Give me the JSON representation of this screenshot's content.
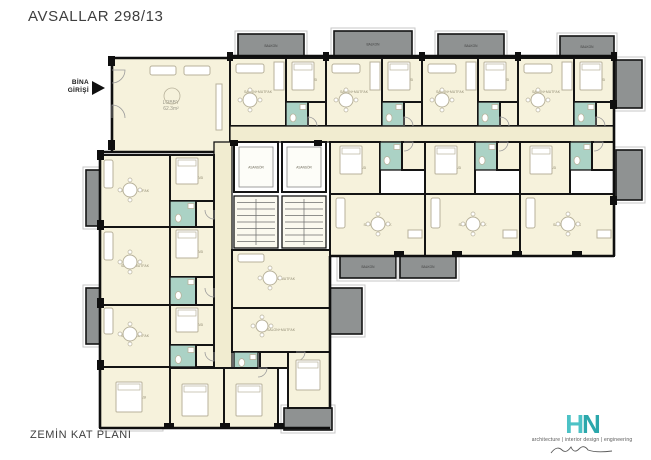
{
  "title": "AVSALLAR 298/13",
  "entrance": {
    "line1": "BİNA",
    "line2": "GİRİŞİ"
  },
  "footer": {
    "floor_label": "ZEMİN KAT PLANI"
  },
  "logo": {
    "h": "H",
    "n": "N",
    "tagline": "architecture | interior design | engineering"
  },
  "colors": {
    "room": "#f6f2dc",
    "corridor": "#f1ecd0",
    "bath": "#abd2c5",
    "stair": "#fbf9ef",
    "lift": "#ffffff",
    "balcony": "#8f9292",
    "balcony_frame": "#c7c7c7",
    "wall": "#141414",
    "furniture": "#b8b29b",
    "door": "#9b9b9b",
    "label": "#928c74",
    "balcony_label": "#3e3e3e",
    "logo_teal": "#3cb8bc"
  },
  "plan": {
    "rooms": [
      {
        "x": 112,
        "y": 58,
        "w": 118,
        "h": 94,
        "t": "room",
        "l": "LOBBY",
        "a": "62.3m²"
      },
      {
        "x": 230,
        "y": 58,
        "w": 56,
        "h": 68,
        "t": "room",
        "l": "SALON+MUTFAK"
      },
      {
        "x": 286,
        "y": 58,
        "w": 40,
        "h": 44,
        "t": "room",
        "l": "YATAK ODASI"
      },
      {
        "x": 286,
        "y": 102,
        "w": 22,
        "h": 24,
        "t": "bath"
      },
      {
        "x": 308,
        "y": 102,
        "w": 18,
        "h": 24,
        "t": "room"
      },
      {
        "x": 326,
        "y": 58,
        "w": 56,
        "h": 68,
        "t": "room",
        "l": "SALON+MUTFAK"
      },
      {
        "x": 382,
        "y": 58,
        "w": 40,
        "h": 44,
        "t": "room",
        "l": "YATAK ODASI"
      },
      {
        "x": 382,
        "y": 102,
        "w": 22,
        "h": 24,
        "t": "bath"
      },
      {
        "x": 404,
        "y": 102,
        "w": 18,
        "h": 24,
        "t": "room"
      },
      {
        "x": 422,
        "y": 58,
        "w": 56,
        "h": 68,
        "t": "room",
        "l": "SALON+MUTFAK"
      },
      {
        "x": 478,
        "y": 58,
        "w": 40,
        "h": 44,
        "t": "room",
        "l": "YATAK ODASI"
      },
      {
        "x": 478,
        "y": 102,
        "w": 22,
        "h": 24,
        "t": "bath"
      },
      {
        "x": 500,
        "y": 102,
        "w": 18,
        "h": 24,
        "t": "room"
      },
      {
        "x": 518,
        "y": 58,
        "w": 56,
        "h": 68,
        "t": "room",
        "l": "SALON+MUTFAK"
      },
      {
        "x": 574,
        "y": 58,
        "w": 40,
        "h": 44,
        "t": "room",
        "l": "YATAK ODASI"
      },
      {
        "x": 574,
        "y": 102,
        "w": 22,
        "h": 24,
        "t": "bath"
      },
      {
        "x": 596,
        "y": 102,
        "w": 18,
        "h": 24,
        "t": "room"
      },
      {
        "x": 230,
        "y": 126,
        "w": 384,
        "h": 16,
        "t": "corridor"
      },
      {
        "x": 330,
        "y": 142,
        "w": 50,
        "h": 52,
        "t": "room",
        "l": "YATAK ODASI"
      },
      {
        "x": 380,
        "y": 142,
        "w": 22,
        "h": 28,
        "t": "bath"
      },
      {
        "x": 402,
        "y": 142,
        "w": 23,
        "h": 28,
        "t": "room"
      },
      {
        "x": 330,
        "y": 194,
        "w": 95,
        "h": 62,
        "t": "room",
        "l": "SALON+MUTFAK"
      },
      {
        "x": 425,
        "y": 142,
        "w": 50,
        "h": 52,
        "t": "room",
        "l": "YATAK ODASI"
      },
      {
        "x": 475,
        "y": 142,
        "w": 22,
        "h": 28,
        "t": "bath"
      },
      {
        "x": 497,
        "y": 142,
        "w": 23,
        "h": 28,
        "t": "room"
      },
      {
        "x": 425,
        "y": 194,
        "w": 95,
        "h": 62,
        "t": "room",
        "l": "SALON+MUTFAK"
      },
      {
        "x": 520,
        "y": 142,
        "w": 50,
        "h": 52,
        "t": "room",
        "l": "YATAK ODASI"
      },
      {
        "x": 570,
        "y": 142,
        "w": 22,
        "h": 28,
        "t": "bath"
      },
      {
        "x": 592,
        "y": 142,
        "w": 22,
        "h": 28,
        "t": "room"
      },
      {
        "x": 520,
        "y": 194,
        "w": 94,
        "h": 62,
        "t": "room",
        "l": "SALON+MUTFAK"
      },
      {
        "x": 234,
        "y": 142,
        "w": 44,
        "h": 50,
        "t": "lift",
        "l": "ASANSÖR"
      },
      {
        "x": 282,
        "y": 142,
        "w": 44,
        "h": 50,
        "t": "lift",
        "l": "ASANSÖR"
      },
      {
        "x": 234,
        "y": 196,
        "w": 44,
        "h": 52,
        "t": "stair"
      },
      {
        "x": 282,
        "y": 196,
        "w": 44,
        "h": 52,
        "t": "stair"
      },
      {
        "x": 214,
        "y": 142,
        "w": 18,
        "h": 238,
        "t": "corridor"
      },
      {
        "x": 100,
        "y": 155,
        "w": 70,
        "h": 72,
        "t": "room",
        "l": "SALON+MUTFAK"
      },
      {
        "x": 170,
        "y": 155,
        "w": 44,
        "h": 46,
        "t": "room",
        "l": "YATAK ODASI"
      },
      {
        "x": 170,
        "y": 201,
        "w": 26,
        "h": 26,
        "t": "bath"
      },
      {
        "x": 196,
        "y": 201,
        "w": 18,
        "h": 26,
        "t": "room"
      },
      {
        "x": 100,
        "y": 227,
        "w": 70,
        "h": 78,
        "t": "room",
        "l": "SALON+MUTFAK"
      },
      {
        "x": 170,
        "y": 227,
        "w": 44,
        "h": 50,
        "t": "room",
        "l": "YATAK ODASI"
      },
      {
        "x": 170,
        "y": 277,
        "w": 26,
        "h": 28,
        "t": "bath"
      },
      {
        "x": 196,
        "y": 277,
        "w": 18,
        "h": 28,
        "t": "room"
      },
      {
        "x": 100,
        "y": 305,
        "w": 70,
        "h": 62,
        "t": "room",
        "l": "SALON+MUTFAK"
      },
      {
        "x": 170,
        "y": 305,
        "w": 44,
        "h": 40,
        "t": "room",
        "l": "YATAK ODASI"
      },
      {
        "x": 170,
        "y": 345,
        "w": 26,
        "h": 22,
        "t": "bath"
      },
      {
        "x": 196,
        "y": 345,
        "w": 18,
        "h": 22,
        "t": "room"
      },
      {
        "x": 100,
        "y": 367,
        "w": 70,
        "h": 61,
        "t": "room",
        "l": "YATAK ODASI"
      },
      {
        "x": 232,
        "y": 250,
        "w": 98,
        "h": 58,
        "t": "room",
        "l": "SALON+MUTFAK"
      },
      {
        "x": 232,
        "y": 308,
        "w": 98,
        "h": 44,
        "t": "room",
        "l": "SALON+MUTFAK"
      },
      {
        "x": 234,
        "y": 352,
        "w": 24,
        "h": 16,
        "t": "bath"
      },
      {
        "x": 260,
        "y": 352,
        "w": 28,
        "h": 16,
        "t": "room"
      },
      {
        "x": 170,
        "y": 368,
        "w": 54,
        "h": 60,
        "t": "room",
        "l": "YATAK ODASI"
      },
      {
        "x": 224,
        "y": 368,
        "w": 54,
        "h": 60,
        "t": "room",
        "l": "YATAK ODASI"
      },
      {
        "x": 288,
        "y": 352,
        "w": 42,
        "h": 56,
        "t": "room",
        "l": "YATAK ODASI"
      }
    ],
    "balconies": [
      {
        "x": 238,
        "y": 34,
        "w": 66,
        "h": 24,
        "l": "BALKON"
      },
      {
        "x": 334,
        "y": 31,
        "w": 78,
        "h": 27,
        "l": "BALKON"
      },
      {
        "x": 438,
        "y": 34,
        "w": 66,
        "h": 24,
        "l": "BALKON"
      },
      {
        "x": 560,
        "y": 36,
        "w": 54,
        "h": 22,
        "l": "BALKON"
      },
      {
        "x": 616,
        "y": 60,
        "w": 26,
        "h": 48
      },
      {
        "x": 616,
        "y": 150,
        "w": 26,
        "h": 50
      },
      {
        "x": 340,
        "y": 256,
        "w": 56,
        "h": 22,
        "l": "BALKON"
      },
      {
        "x": 400,
        "y": 256,
        "w": 56,
        "h": 22,
        "l": "BALKON"
      },
      {
        "x": 86,
        "y": 170,
        "w": 16,
        "h": 56
      },
      {
        "x": 86,
        "y": 288,
        "w": 16,
        "h": 56
      },
      {
        "x": 330,
        "y": 288,
        "w": 32,
        "h": 46
      },
      {
        "x": 284,
        "y": 408,
        "w": 48,
        "h": 22
      },
      {
        "x": 104,
        "y": 400,
        "w": 56,
        "h": 28
      }
    ],
    "walls": [
      [
        112,
        58,
        230,
        58
      ],
      [
        230,
        56,
        614,
        56
      ],
      [
        112,
        58,
        112,
        152
      ],
      [
        100,
        152,
        214,
        152
      ],
      [
        100,
        152,
        100,
        428
      ],
      [
        100,
        428,
        330,
        428
      ],
      [
        330,
        256,
        330,
        408
      ],
      [
        614,
        56,
        614,
        256
      ],
      [
        330,
        256,
        614,
        256
      ]
    ],
    "piers": [
      [
        227,
        52,
        6,
        9
      ],
      [
        323,
        52,
        6,
        9
      ],
      [
        419,
        52,
        6,
        9
      ],
      [
        515,
        52,
        6,
        9
      ],
      [
        611,
        52,
        6,
        9
      ],
      [
        97,
        150,
        7,
        10
      ],
      [
        97,
        220,
        7,
        10
      ],
      [
        97,
        298,
        7,
        10
      ],
      [
        97,
        360,
        7,
        10
      ],
      [
        108,
        56,
        7,
        10
      ],
      [
        108,
        140,
        7,
        10
      ],
      [
        164,
        423,
        10,
        6
      ],
      [
        220,
        423,
        10,
        6
      ],
      [
        274,
        423,
        10,
        6
      ],
      [
        610,
        100,
        7,
        9
      ],
      [
        610,
        196,
        7,
        9
      ],
      [
        394,
        251,
        10,
        6
      ],
      [
        452,
        251,
        10,
        6
      ],
      [
        512,
        251,
        10,
        6
      ],
      [
        572,
        251,
        10,
        6
      ],
      [
        230,
        140,
        8,
        6
      ],
      [
        314,
        140,
        8,
        6
      ]
    ],
    "doors": [
      {
        "x": 112,
        "y": 70,
        "r": 13,
        "q": 0
      },
      {
        "x": 112,
        "y": 118,
        "r": 13,
        "q": 3
      },
      {
        "x": 308,
        "y": 126,
        "r": 9,
        "q": 3
      },
      {
        "x": 404,
        "y": 126,
        "r": 9,
        "q": 3
      },
      {
        "x": 500,
        "y": 126,
        "r": 9,
        "q": 3
      },
      {
        "x": 596,
        "y": 126,
        "r": 9,
        "q": 3
      },
      {
        "x": 404,
        "y": 142,
        "r": 9,
        "q": 0
      },
      {
        "x": 499,
        "y": 142,
        "r": 9,
        "q": 0
      },
      {
        "x": 594,
        "y": 142,
        "r": 9,
        "q": 0
      },
      {
        "x": 214,
        "y": 210,
        "r": 9,
        "q": 1
      },
      {
        "x": 214,
        "y": 288,
        "r": 9,
        "q": 1
      },
      {
        "x": 214,
        "y": 352,
        "r": 9,
        "q": 1
      },
      {
        "x": 258,
        "y": 368,
        "r": 9,
        "q": 0
      },
      {
        "x": 296,
        "y": 352,
        "r": 9,
        "q": 0
      }
    ],
    "furniture": [
      {
        "t": "sofa",
        "x": 150,
        "y": 66,
        "w": 26,
        "h": 9
      },
      {
        "t": "sofa",
        "x": 184,
        "y": 66,
        "w": 26,
        "h": 9
      },
      {
        "t": "desk",
        "x": 216,
        "y": 84,
        "w": 6,
        "h": 46
      },
      {
        "t": "rug",
        "cx": 172,
        "cy": 96,
        "r": 8
      },
      {
        "t": "sofa",
        "x": 236,
        "y": 64,
        "w": 28,
        "h": 9
      },
      {
        "t": "table",
        "cx": 250,
        "cy": 100,
        "r": 7
      },
      {
        "t": "counter",
        "x": 274,
        "y": 62,
        "w": 10,
        "h": 28
      },
      {
        "t": "bed",
        "x": 292,
        "y": 62,
        "w": 22,
        "h": 28
      },
      {
        "t": "sofa",
        "x": 332,
        "y": 64,
        "w": 28,
        "h": 9
      },
      {
        "t": "table",
        "cx": 346,
        "cy": 100,
        "r": 7
      },
      {
        "t": "counter",
        "x": 370,
        "y": 62,
        "w": 10,
        "h": 28
      },
      {
        "t": "bed",
        "x": 388,
        "y": 62,
        "w": 22,
        "h": 28
      },
      {
        "t": "sofa",
        "x": 428,
        "y": 64,
        "w": 28,
        "h": 9
      },
      {
        "t": "table",
        "cx": 442,
        "cy": 100,
        "r": 7
      },
      {
        "t": "counter",
        "x": 466,
        "y": 62,
        "w": 10,
        "h": 28
      },
      {
        "t": "bed",
        "x": 484,
        "y": 62,
        "w": 22,
        "h": 28
      },
      {
        "t": "sofa",
        "x": 524,
        "y": 64,
        "w": 28,
        "h": 9
      },
      {
        "t": "table",
        "cx": 538,
        "cy": 100,
        "r": 7
      },
      {
        "t": "counter",
        "x": 562,
        "y": 62,
        "w": 10,
        "h": 28
      },
      {
        "t": "bed",
        "x": 580,
        "y": 62,
        "w": 22,
        "h": 28
      },
      {
        "t": "bed",
        "x": 340,
        "y": 146,
        "w": 22,
        "h": 28
      },
      {
        "t": "table",
        "cx": 378,
        "cy": 224,
        "r": 7
      },
      {
        "t": "sofa",
        "x": 336,
        "y": 198,
        "w": 9,
        "h": 30
      },
      {
        "t": "counter",
        "x": 408,
        "y": 230,
        "w": 14,
        "h": 8
      },
      {
        "t": "bed",
        "x": 435,
        "y": 146,
        "w": 22,
        "h": 28
      },
      {
        "t": "table",
        "cx": 473,
        "cy": 224,
        "r": 7
      },
      {
        "t": "sofa",
        "x": 431,
        "y": 198,
        "w": 9,
        "h": 30
      },
      {
        "t": "counter",
        "x": 503,
        "y": 230,
        "w": 14,
        "h": 8
      },
      {
        "t": "bed",
        "x": 530,
        "y": 146,
        "w": 22,
        "h": 28
      },
      {
        "t": "table",
        "cx": 568,
        "cy": 224,
        "r": 7
      },
      {
        "t": "sofa",
        "x": 526,
        "y": 198,
        "w": 9,
        "h": 30
      },
      {
        "t": "counter",
        "x": 597,
        "y": 230,
        "w": 14,
        "h": 8
      },
      {
        "t": "table",
        "cx": 130,
        "cy": 190,
        "r": 7
      },
      {
        "t": "sofa",
        "x": 104,
        "y": 160,
        "w": 9,
        "h": 28
      },
      {
        "t": "bed",
        "x": 176,
        "y": 158,
        "w": 22,
        "h": 26
      },
      {
        "t": "table",
        "cx": 130,
        "cy": 262,
        "r": 7
      },
      {
        "t": "sofa",
        "x": 104,
        "y": 232,
        "w": 9,
        "h": 28
      },
      {
        "t": "bed",
        "x": 176,
        "y": 230,
        "w": 22,
        "h": 28
      },
      {
        "t": "table",
        "cx": 130,
        "cy": 334,
        "r": 7
      },
      {
        "t": "sofa",
        "x": 104,
        "y": 308,
        "w": 9,
        "h": 26
      },
      {
        "t": "bed",
        "x": 176,
        "y": 308,
        "w": 22,
        "h": 24
      },
      {
        "t": "bed",
        "x": 116,
        "y": 382,
        "w": 26,
        "h": 30
      },
      {
        "t": "table",
        "cx": 270,
        "cy": 278,
        "r": 7
      },
      {
        "t": "sofa",
        "x": 238,
        "y": 254,
        "w": 26,
        "h": 8
      },
      {
        "t": "table",
        "cx": 262,
        "cy": 326,
        "r": 6
      },
      {
        "t": "bed",
        "x": 182,
        "y": 384,
        "w": 26,
        "h": 32
      },
      {
        "t": "bed",
        "x": 236,
        "y": 384,
        "w": 26,
        "h": 32
      },
      {
        "t": "bed",
        "x": 296,
        "y": 360,
        "w": 24,
        "h": 30
      }
    ]
  }
}
